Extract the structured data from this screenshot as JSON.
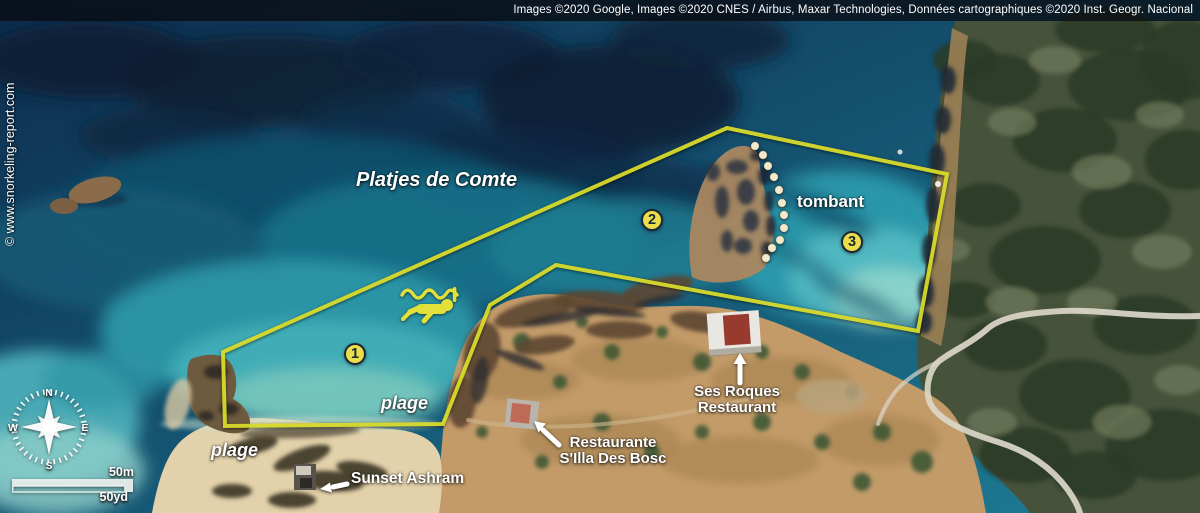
{
  "attribution": {
    "text": "Images ©2020 Google, Images ©2020 CNES / Airbus, Maxar Technologies, Données cartographiques ©2020 Inst. Geogr. Nacional"
  },
  "watermark": {
    "text": "© www.snorkeling-report.com"
  },
  "map": {
    "place_label": "Platjes de Comte",
    "feature_labels": {
      "tombant": "tombant",
      "plage_upper": "plage",
      "plage_lower": "plage"
    },
    "poi_labels": {
      "ses_roques": [
        "Ses Roques",
        "Restaurant"
      ],
      "silla": [
        "Restaurante",
        "S'Illa Des Bosc"
      ],
      "sunset_ashram": "Sunset Ashram"
    }
  },
  "overlay": {
    "zone_polygon": {
      "points": [
        [
          223,
          352
        ],
        [
          727,
          128
        ],
        [
          947,
          174
        ],
        [
          918,
          331
        ],
        [
          556,
          265
        ],
        [
          490,
          305
        ],
        [
          443,
          424
        ],
        [
          225,
          426
        ]
      ]
    },
    "tombant_dots": {
      "points": [
        [
          755,
          146
        ],
        [
          763,
          155
        ],
        [
          768,
          166
        ],
        [
          774,
          177
        ],
        [
          779,
          190
        ],
        [
          782,
          203
        ],
        [
          784,
          215
        ],
        [
          784,
          228
        ],
        [
          780,
          240
        ],
        [
          772,
          248
        ],
        [
          766,
          258
        ]
      ]
    },
    "markers": [
      {
        "label": "1",
        "x": 355,
        "y": 354
      },
      {
        "label": "2",
        "x": 652,
        "y": 220
      },
      {
        "label": "3",
        "x": 852,
        "y": 242
      }
    ]
  },
  "compass": {
    "n": "N",
    "e": "E",
    "s": "S",
    "w": "W"
  },
  "scale_bar": {
    "metric_label": "50m",
    "imperial_label": "50yd"
  },
  "colors": {
    "zone_outline": "#d9da2b",
    "marker_fill": "#eade4a",
    "marker_text": "#1c2636",
    "dot_fill": "#f2eaca",
    "snorkeler_icon": "#e4e03b",
    "label_text": "#ffffff"
  },
  "icons": [
    "snorkeler-icon",
    "compass-rose-icon",
    "pointer-arrow-icon",
    "tombant-dot"
  ]
}
